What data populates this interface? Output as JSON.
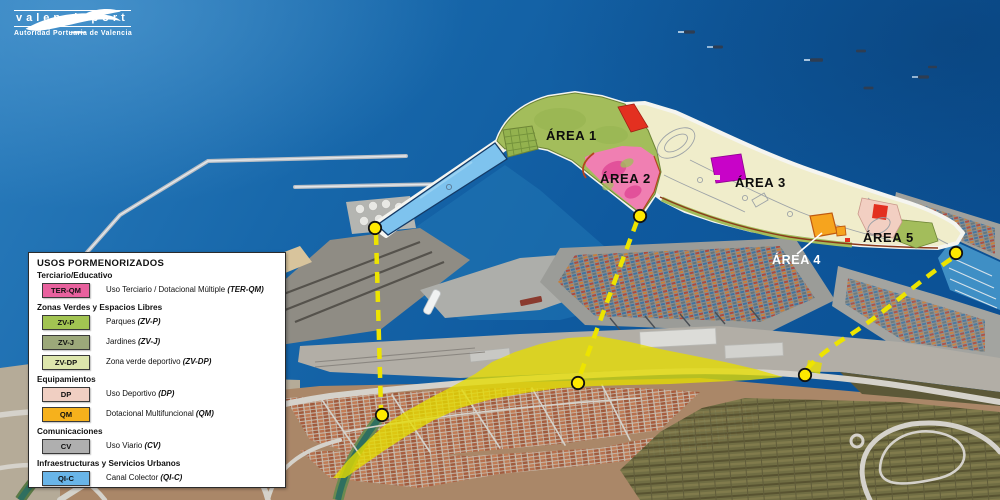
{
  "logo": {
    "name": "valenciaport",
    "subtitle": "Autoridad Portuaria de Valencia"
  },
  "map": {
    "areas": [
      {
        "id": "area-1",
        "label": "ÁREA 1"
      },
      {
        "id": "area-2",
        "label": "ÁREA 2"
      },
      {
        "id": "area-3",
        "label": "ÁREA 3"
      },
      {
        "id": "area-4",
        "label": "ÁREA 4"
      },
      {
        "id": "area-5",
        "label": "ÁREA 5"
      }
    ],
    "colors": {
      "parks_green": "#A3BD5B",
      "plan_cream": "#F0EDCB",
      "terciario_pink": "#F07FB2",
      "canal_blue": "#7EC3EE",
      "deportivo_red": "#E33020",
      "dotacional_orange": "#F6A41E",
      "plan_magenta": "#C803C8",
      "highlight_yellow": "#E6DD00",
      "connector_yellow": "#EDE400",
      "dot_fill": "#FFE900"
    }
  },
  "legend": {
    "title": "USOS PORMENORIZADOS",
    "sections": [
      {
        "header": "Terciario/Educativo",
        "items": [
          {
            "code": "TER-QM",
            "color": "#E8619E",
            "desc": "Uso Terciario / Dotacional Múltiple",
            "code_paren": "(TER-QM)"
          }
        ]
      },
      {
        "header": "Zonas Verdes y Espacios Libres",
        "items": [
          {
            "code": "ZV-P",
            "color": "#A2C452",
            "desc": "Parques",
            "code_paren": "(ZV-P)"
          },
          {
            "code": "ZV-J",
            "color": "#9CA87A",
            "desc": "Jardines",
            "code_paren": "(ZV-J)"
          },
          {
            "code": "ZV-DP",
            "color": "#DDE6AC",
            "desc": "Zona verde deportivo",
            "code_paren": "(ZV-DP)"
          }
        ]
      },
      {
        "header": "Equipamientos",
        "items": [
          {
            "code": "DP",
            "color": "#F0CFC2",
            "desc": "Uso Deportivo",
            "code_paren": "(DP)"
          },
          {
            "code": "QM",
            "color": "#F6B11C",
            "desc": "Dotacional Multifuncional",
            "code_paren": "(QM)"
          }
        ]
      },
      {
        "header": "Comunicaciones",
        "items": [
          {
            "code": "CV",
            "color": "#AFAFAF",
            "desc": "Uso Viario",
            "code_paren": "(CV)"
          }
        ]
      },
      {
        "header": "Infraestructuras y Servicios Urbanos",
        "items": [
          {
            "code": "QI-C",
            "color": "#69B5E8",
            "desc": "Canal Colector",
            "code_paren": "(QI-C)"
          }
        ]
      }
    ]
  }
}
